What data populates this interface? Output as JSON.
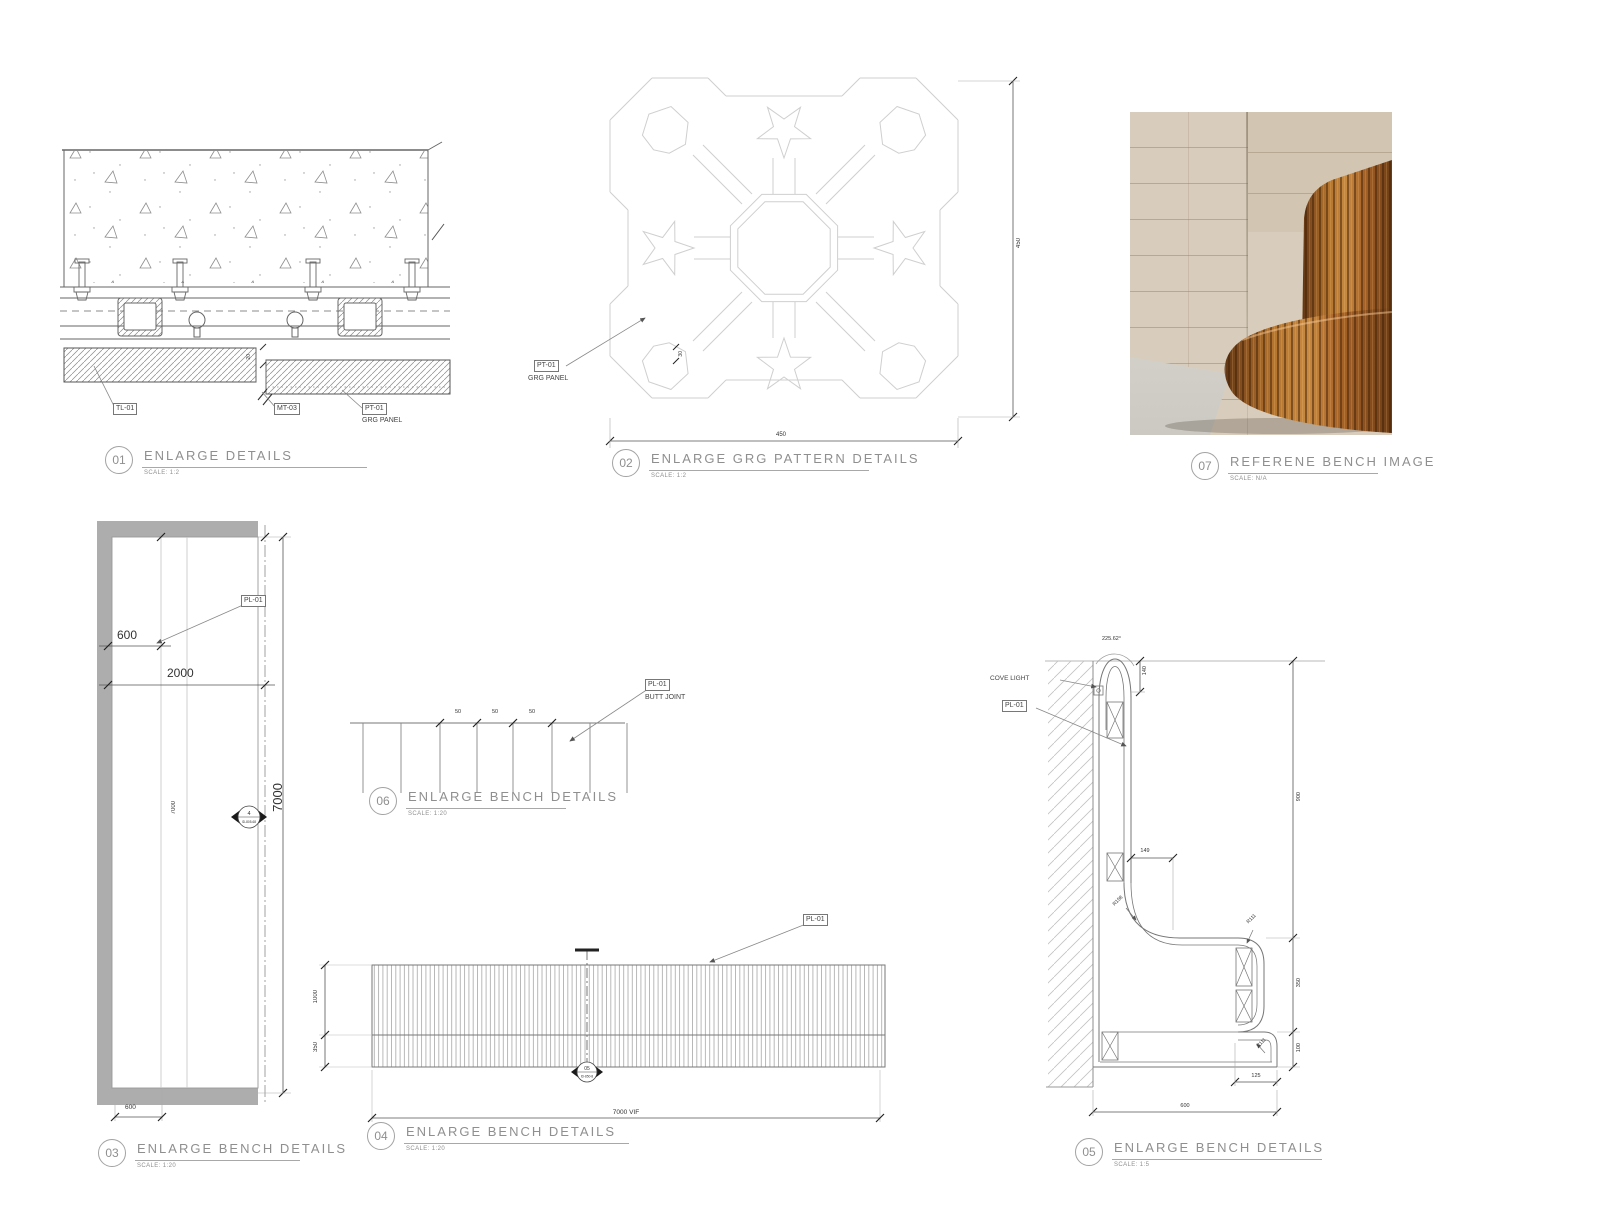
{
  "colors": {
    "line": "#6e6e6e",
    "pattern_line": "#cfcfcf",
    "gray_fill": "#adadad",
    "title_gray": "#8f8f8f",
    "wood": "#b5762f",
    "wall_tile": "#d8cdbc",
    "floor": "#dbd8d2"
  },
  "details": {
    "d01": {
      "num": "01",
      "title": "ENLARGE DETAILS",
      "scale": "SCALE: 1:2",
      "tags": {
        "tl": "TL-01",
        "mt": "MT-03",
        "pt": "PT-01",
        "pt_sub": "GRG PANEL"
      },
      "dims": {
        "step": "20"
      }
    },
    "d02": {
      "num": "02",
      "title": "ENLARGE GRG PATTERN DETAILS",
      "scale": "SCALE: 1:2",
      "tags": {
        "pt": "PT-01",
        "pt_sub": "GRG PANEL"
      },
      "dims": {
        "width": "450",
        "height": "450",
        "inner": "30"
      }
    },
    "d03": {
      "num": "03",
      "title": "ENLARGE BENCH DETAILS",
      "scale": "SCALE: 1:20",
      "tags": {
        "pl": "PL-01"
      },
      "dims": {
        "top600": "600",
        "w2000": "2000",
        "h7000": "7000",
        "inner7000": "7000",
        "bottom600": "600"
      },
      "marker": {
        "no": "4",
        "ref": "ID-805-68"
      }
    },
    "d04": {
      "num": "04",
      "title": "ENLARGE BENCH DETAILS",
      "scale": "SCALE: 1:20",
      "tags": {
        "pl": "PL-01"
      },
      "dims": {
        "h1000": "1000",
        "h350": "350",
        "w": "7000 VIF"
      },
      "marker": {
        "no": "05",
        "ref": "ID-850-8"
      }
    },
    "d05": {
      "num": "05",
      "title": "ENLARGE BENCH DETAILS",
      "scale": "SCALE: 1:5",
      "tags": {
        "cove": "COVE LIGHT",
        "pl": "PL-01"
      },
      "dims": {
        "angle": "225.62°",
        "d140": "140",
        "d900": "900",
        "d149": "149",
        "r158": "R158",
        "r111": "R111",
        "d350": "350",
        "d100": "100",
        "d125": "125",
        "d600": "600"
      }
    },
    "d06": {
      "num": "06",
      "title": "ENLARGE BENCH DETAILS",
      "scale": "SCALE: 1:20",
      "tags": {
        "pl": "PL-01",
        "pl_sub": "BUTT JOINT"
      },
      "dims": {
        "s50": "50"
      }
    },
    "d07": {
      "num": "07",
      "title": "REFERENE BENCH IMAGE",
      "scale": "SCALE: N/A"
    }
  }
}
